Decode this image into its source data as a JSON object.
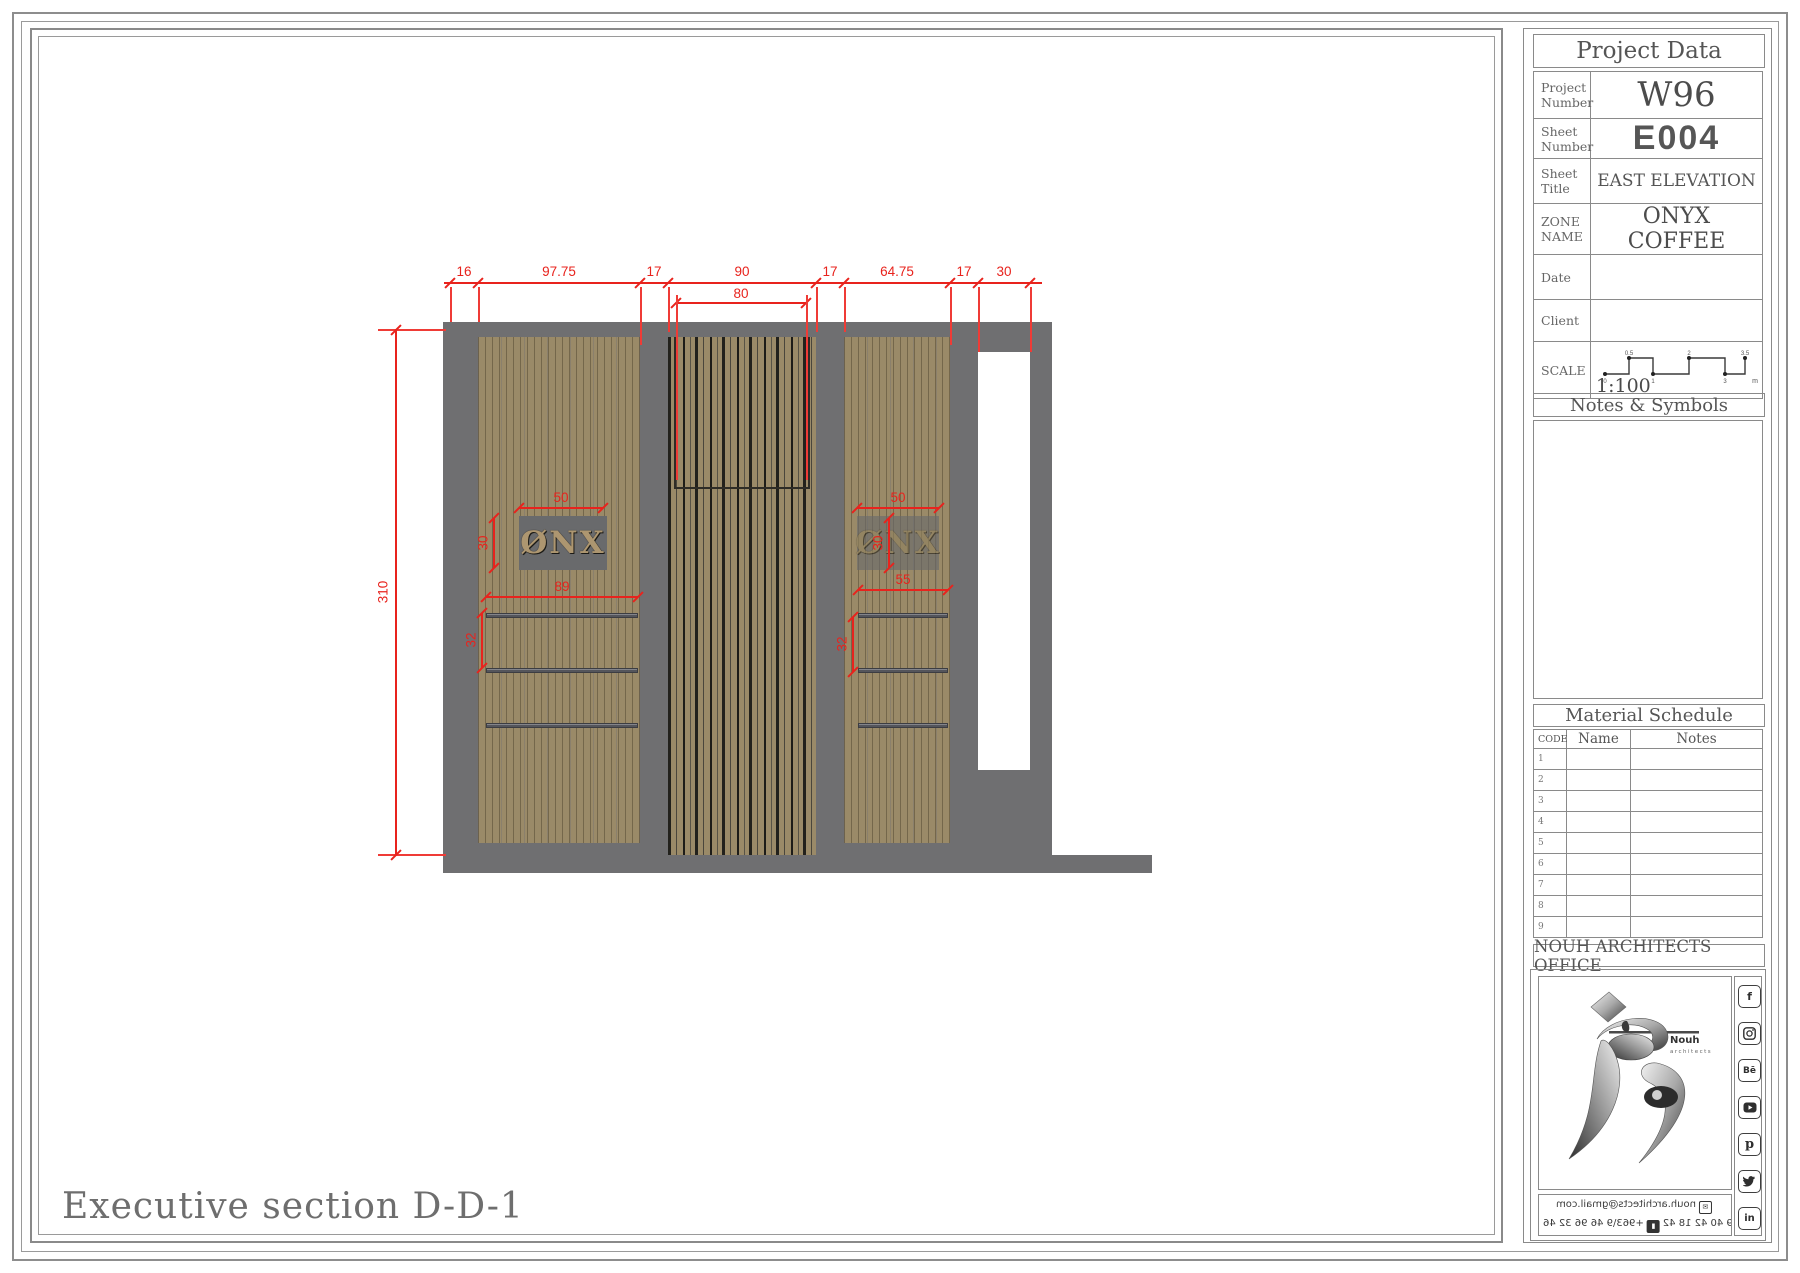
{
  "colors": {
    "accent_red": "#e8231d",
    "wall_gray": "#6f6f71",
    "wood_tan": "#9a8a68"
  },
  "drawing": {
    "title": "Executive section D-D-1",
    "dims_top": [
      "16",
      "97.75",
      "17",
      "90",
      "17",
      "64.75",
      "17",
      "30"
    ],
    "dim_sub": "80",
    "dim_height": "310",
    "left_panel": {
      "sign_text": "ØNX",
      "dim_sign_w": "50",
      "dim_sign_h": "30",
      "dim_shelf": "89",
      "dim_gap": "32"
    },
    "right_panel": {
      "sign_text": "ØNX",
      "dim_sign_w": "50",
      "dim_sign_h": "30",
      "dim_shelf": "55",
      "dim_gap": "32"
    }
  },
  "project_data": {
    "title": "Project Data",
    "rows": [
      {
        "label": "Project Number",
        "value": "W96"
      },
      {
        "label": "Sheet Number",
        "value": "E004"
      },
      {
        "label": "Sheet Title",
        "value": "EAST ELEVATION"
      },
      {
        "label": "ZONE NAME",
        "value": "ONYX COFFEE"
      },
      {
        "label": "Date",
        "value": ""
      },
      {
        "label": "Client",
        "value": ""
      },
      {
        "label": "SCALE",
        "value": "1:100"
      }
    ],
    "scale_bar": {
      "top_labels": [
        "0.5",
        "2",
        "3.5"
      ],
      "bottom_labels": [
        "0",
        "1",
        "3",
        "m"
      ]
    }
  },
  "notes": {
    "title": "Notes & Symbols"
  },
  "material_schedule": {
    "title": "Material Schedule",
    "columns": [
      "CODE",
      "Name",
      "Notes"
    ],
    "rows": [
      {
        "code": "1",
        "name": "",
        "notes": ""
      },
      {
        "code": "2",
        "name": "",
        "notes": ""
      },
      {
        "code": "3",
        "name": "",
        "notes": ""
      },
      {
        "code": "4",
        "name": "",
        "notes": ""
      },
      {
        "code": "5",
        "name": "",
        "notes": ""
      },
      {
        "code": "6",
        "name": "",
        "notes": ""
      },
      {
        "code": "7",
        "name": "",
        "notes": ""
      },
      {
        "code": "8",
        "name": "",
        "notes": ""
      },
      {
        "code": "9",
        "name": "",
        "notes": ""
      }
    ]
  },
  "office": {
    "name": "NOUH ARCHITECTS OFFICE",
    "logo_name": "Nouh",
    "logo_tagline": "architects",
    "email": "nouh.architects@gmail.com",
    "phone1": "+963\\9 40 42 18 42",
    "phone2": "+963\\9 46 96 32 46",
    "social": [
      {
        "name": "facebook",
        "glyph": "f"
      },
      {
        "name": "instagram",
        "glyph": ""
      },
      {
        "name": "behance",
        "glyph": "Bē"
      },
      {
        "name": "youtube",
        "glyph": "▶"
      },
      {
        "name": "pinterest",
        "glyph": "p"
      },
      {
        "name": "twitter",
        "glyph": "t"
      },
      {
        "name": "linkedin",
        "glyph": "in"
      }
    ]
  }
}
